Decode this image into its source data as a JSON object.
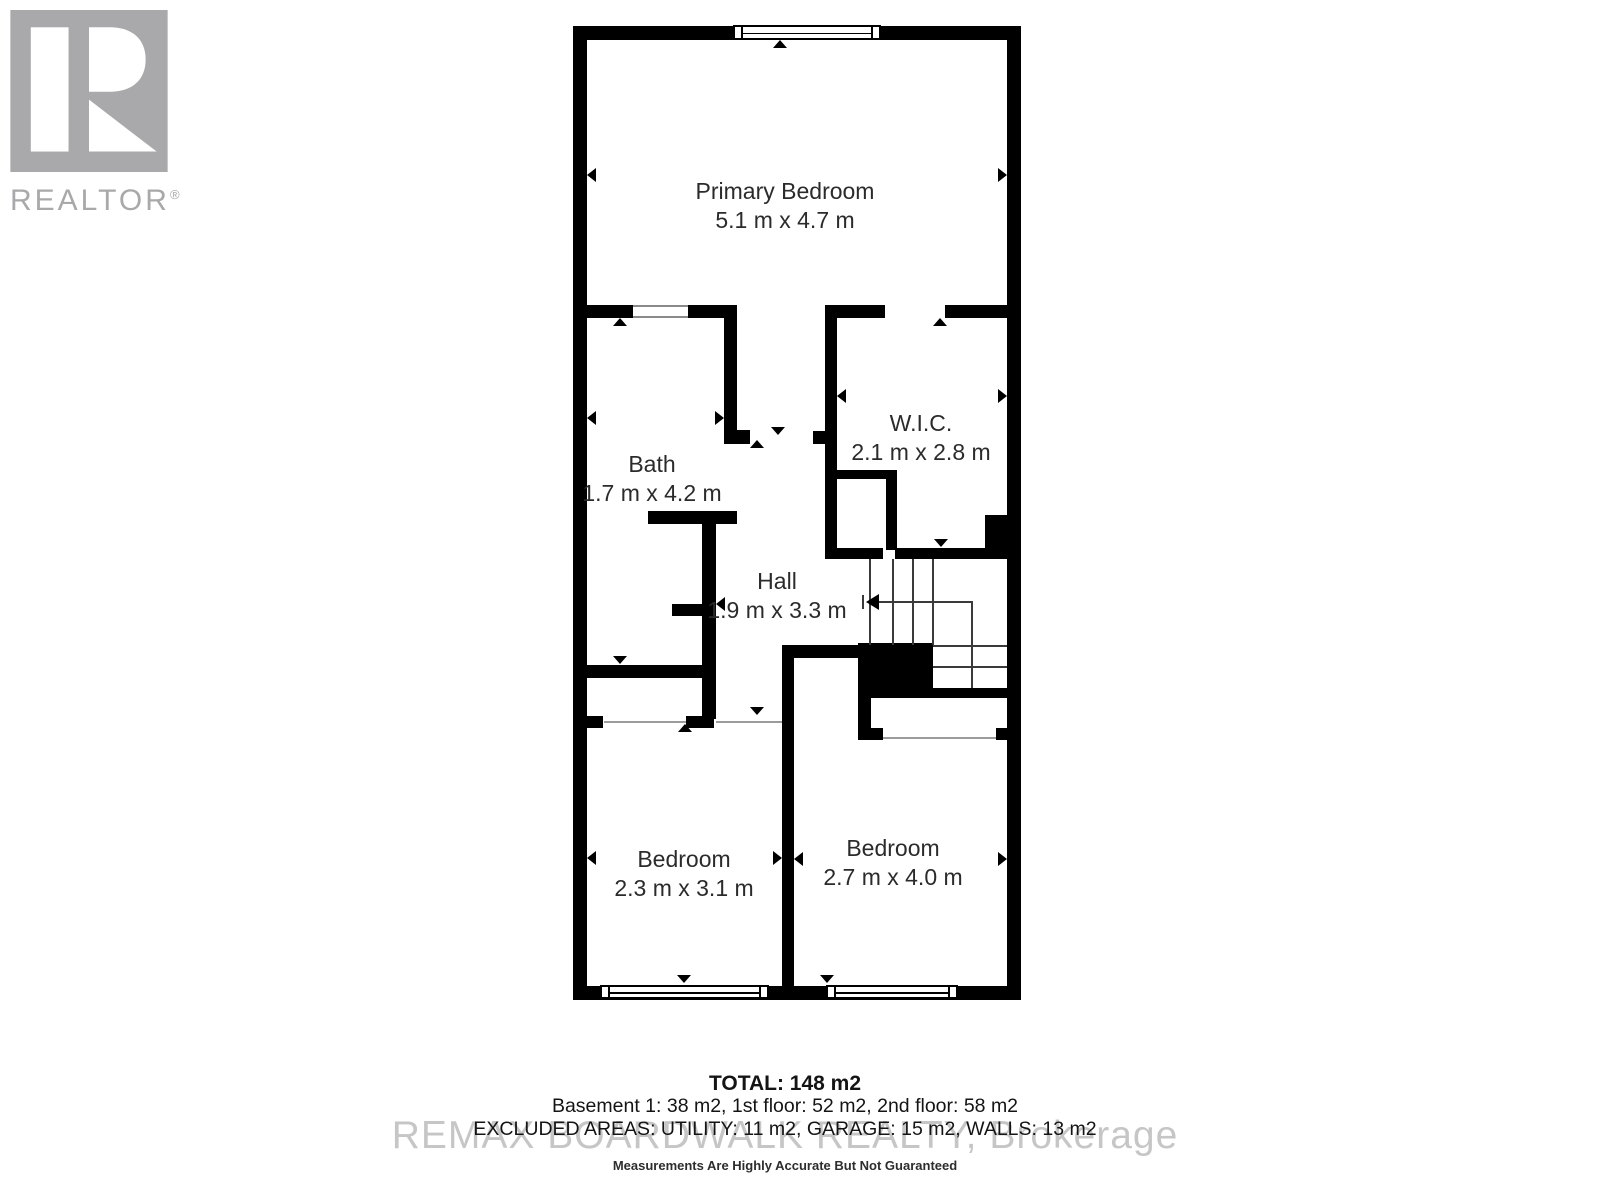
{
  "logo": {
    "brand": "REALTOR",
    "reg": "®"
  },
  "rooms": [
    {
      "id": "primary-bedroom",
      "name": "Primary Bedroom",
      "dims": "5.1 m x 4.7 m"
    },
    {
      "id": "bath",
      "name": "Bath",
      "dims": "1.7 m x 4.2 m"
    },
    {
      "id": "wic",
      "name": "W.I.C.",
      "dims": "2.1 m x 2.8 m"
    },
    {
      "id": "hall",
      "name": "Hall",
      "dims": "1.9 m x 3.3 m"
    },
    {
      "id": "bedroom-left",
      "name": "Bedroom",
      "dims": "2.3 m x 3.1 m"
    },
    {
      "id": "bedroom-right",
      "name": "Bedroom",
      "dims": "2.7 m x 4.0 m"
    }
  ],
  "summary": {
    "total": "TOTAL: 148 m2",
    "floors": "Basement 1: 38 m2, 1st floor: 52 m2, 2nd floor: 58 m2",
    "excluded": "EXCLUDED AREAS: UTILITY: 11 m2, GARAGE: 15 m2, WALLS: 13 m2",
    "disclaimer": "Measurements Are Highly Accurate But Not Guaranteed"
  },
  "watermark": "REMAX BOARDWALK REALTY, Brokerage",
  "colors": {
    "wall": "#000000",
    "room_text": "#2b2b2b",
    "logo": "#a9a9ab",
    "watermark": "#8f8f8f",
    "footer_text": "#141414"
  }
}
